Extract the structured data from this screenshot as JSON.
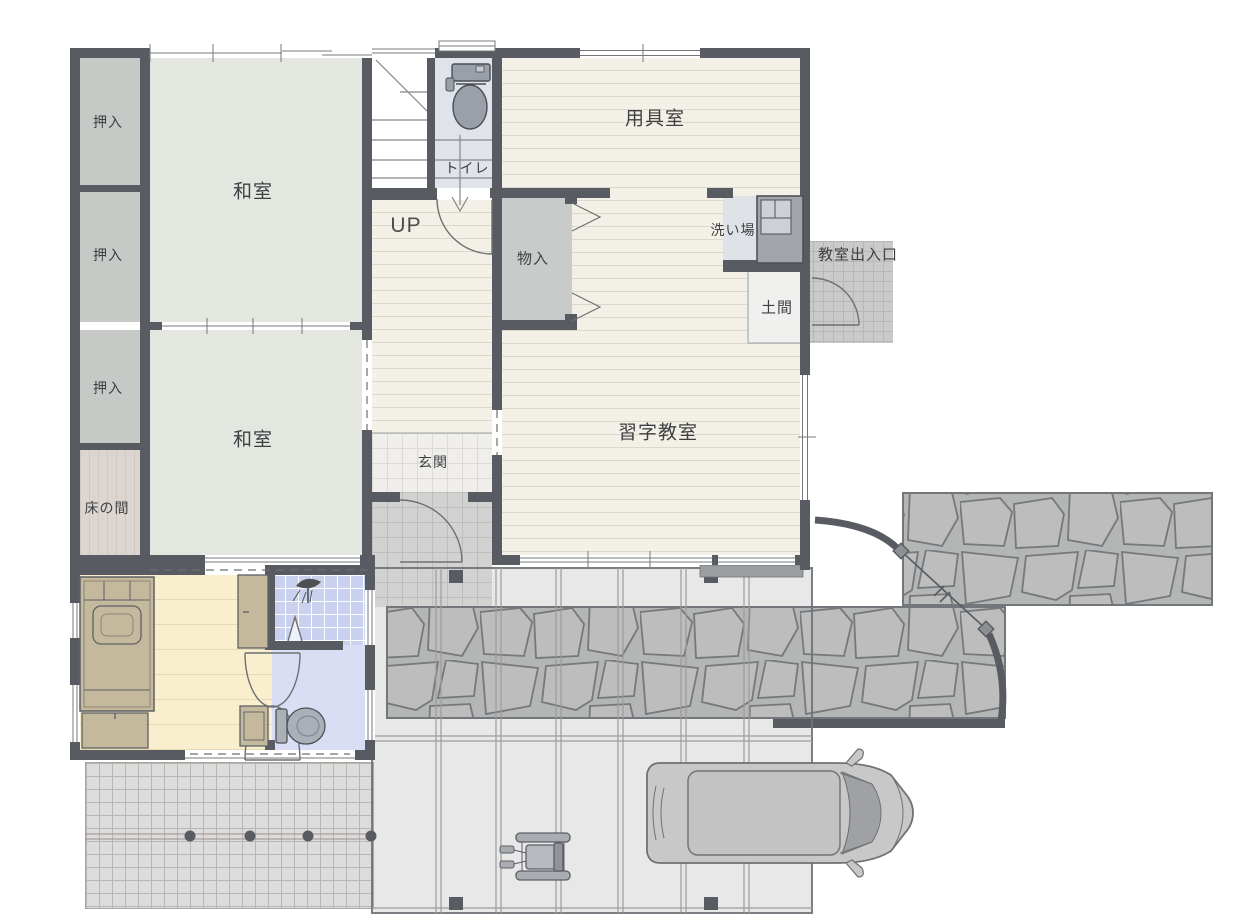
{
  "rooms": {
    "oshiire": "押入",
    "washitsu": "和室",
    "tokonoma": "床の間",
    "toilet": "トイレ",
    "up": "UP",
    "equipment": "用具室",
    "storage": "物入",
    "washing": "洗い場",
    "classroom_entrance": "教室出入口",
    "doma": "土間",
    "classroom": "習字教室",
    "genkan": "玄関"
  },
  "icons": {
    "toilet_fixture": "toilet-icon",
    "shower": "shower-icon",
    "sink_unit": "sink-icon",
    "car": "car-icon",
    "wheelchair": "wheelchair-icon",
    "bed": "bed-icon",
    "gate": "gate-arc-icon",
    "door": "door-arc-icon"
  },
  "colors": {
    "wall": "#585c62",
    "tatami": "#e4e6e0",
    "closet": "#c7c9c7",
    "wood_floor": "#f3f1e7",
    "bedroom_floor": "#f9efce",
    "bath_tile": "#c9d1ee",
    "washroom_floor": "#d9def5",
    "toilet_room": "#e0e4ea",
    "stone": "#b6b7b7",
    "carport": "#e8e8e8",
    "text": "#3e4043"
  }
}
